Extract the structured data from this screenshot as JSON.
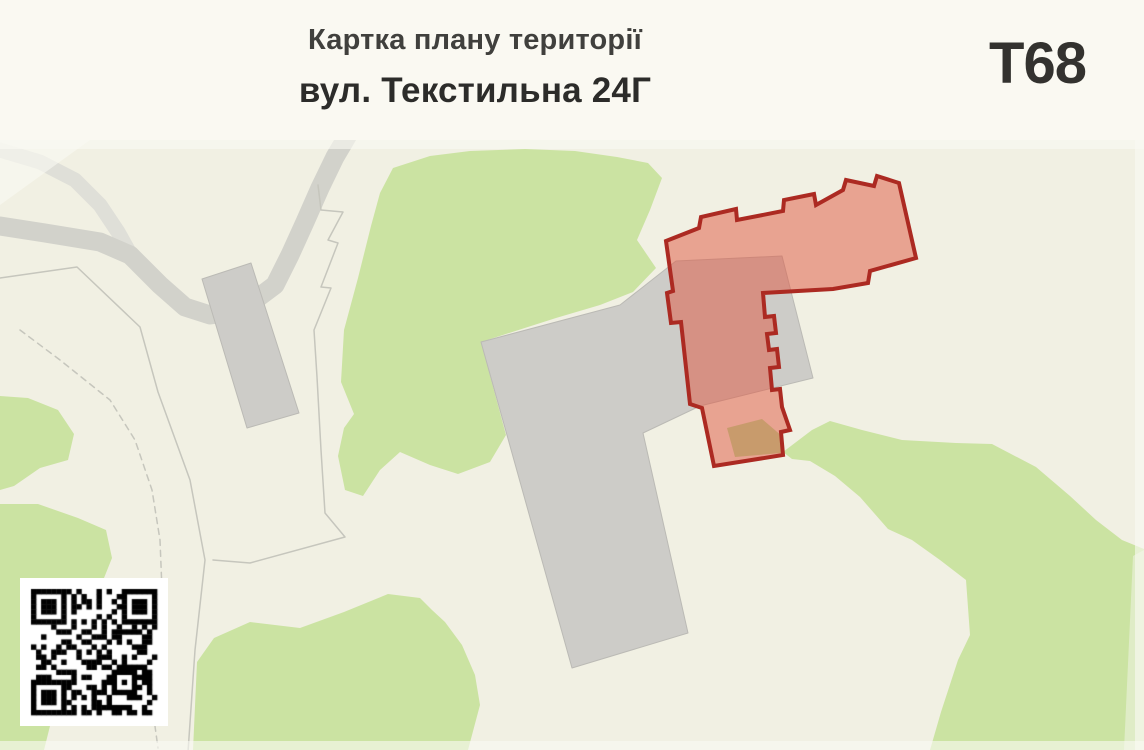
{
  "header": {
    "title": "Картка плану території",
    "subtitle": "вул. Текстильна 24Г",
    "badge": "Т68"
  },
  "map": {
    "colors": {
      "background": "#f1f0e3",
      "green": "#cbe3a2",
      "green_light": "#dfecc6",
      "road": "#d2d2cb",
      "road_light": "#dfdfd8",
      "parcel": "#c6c6bd",
      "building": "#cdccc8",
      "building_edge": "#bbbab5",
      "highlight_fill": "rgba(223,86,64,0.5)",
      "highlight_stroke": "#ac2a22",
      "tan": "#bf9963",
      "fade": "rgba(250,250,243,0.6)"
    },
    "features": [
      {
        "name": "greenery-central",
        "type": "polygon",
        "fill": "green",
        "points": "393,168 430,156 470,151 525,149 575,151 617,157 648,163 662,178 650,210 637,240 656,268 633,292 600,305 556,318 481,342 506,435 490,462 458,474 430,465 400,452 380,470 363,496 345,490 338,456 344,428 354,414 341,382 344,330 358,278 371,226 380,193"
      },
      {
        "name": "greenery-bottom-center",
        "type": "polygon",
        "fill": "green",
        "points": "193,750 197,662 214,638 250,622 300,628 344,612 388,594 420,598 432,610 445,622 462,645 475,675 480,705 468,750"
      },
      {
        "name": "greenery-left-upper",
        "type": "polygon",
        "fill": "green",
        "points": "0,396 28,398 58,410 74,434 68,460 40,468 14,486 0,490"
      },
      {
        "name": "greenery-left-lower",
        "type": "polygon",
        "fill": "green",
        "points": "0,504 38,504 78,518 106,530 112,558 100,588 102,616 88,638 60,648 48,678 52,718 44,750 0,750"
      },
      {
        "name": "greenery-bottom-right",
        "type": "polygon",
        "fill": "green",
        "points": "783,452 812,430 830,421 862,430 902,440 956,443 992,444 1036,467 1070,496 1096,520 1122,540 1144,549 1144,750 930,750 941,712 958,660 970,635 966,580 940,560 912,540 888,529 860,497 835,476 810,461 792,459"
      },
      {
        "name": "greenery-right-edge",
        "type": "polygon",
        "fill": "green_light",
        "points": "1133,556 1144,550 1144,750 1124,750"
      },
      {
        "name": "road-secondary",
        "type": "polyline",
        "stroke": "road_light",
        "width": 15,
        "points": "0,150 40,162 75,180 100,205 118,232 128,250"
      },
      {
        "name": "road-main",
        "type": "polyline",
        "stroke": "road",
        "width": 19,
        "points": "0,226 45,233 100,242 130,255 160,285 185,307 210,315 235,312 255,300 275,285 290,255 305,222 320,188 335,157 348,135"
      },
      {
        "name": "parcel-line-west",
        "type": "polyline",
        "stroke": "parcel",
        "width": 1.5,
        "points": "0,278 77,267 140,327 158,392 190,480 205,560 195,650 188,752"
      },
      {
        "name": "parcel-line-east",
        "type": "polyline",
        "stroke": "parcel",
        "width": 1.5,
        "points": "318,185 321,210 343,212 328,240 338,243 321,287 331,288 314,330 317,377 321,450 325,513 345,537 250,563 213,560"
      },
      {
        "name": "parcel-line-dashed",
        "type": "polyline",
        "stroke": "parcel",
        "width": 1.5,
        "dash": "6 5",
        "points": "20,330 60,360 110,400 135,440 152,490 160,540 162,590 156,640 150,690 158,748"
      },
      {
        "name": "building-small",
        "type": "polygon",
        "fill": "building",
        "stroke": "building_edge",
        "width": 1,
        "points": "202,279 251,263 299,413 247,428"
      },
      {
        "name": "building-complex",
        "type": "polygon",
        "fill": "building",
        "stroke": "building_edge",
        "width": 1,
        "points": "481,342 620,305 676,261 782,256 813,378 700,406 643,433 688,633 572,668"
      },
      {
        "name": "highlight-parcel-fill",
        "type": "polygon",
        "fill": "highlight_fill",
        "points": "666,241 699,228 701,217 736,209 737,220 783,211 784,200 814,194 816,205 843,190 846,180 874,186 877,176 899,183 916,258 870,271 868,283 833,289 763,293 765,317 774,316 776,333 767,334 769,350 777,349 779,367 770,368 772,390 780,389 782,407 790,430 781,432 783,455 714,466 702,408 690,404 681,322 671,323 667,293 673,291"
      },
      {
        "name": "ground-patch-tan",
        "type": "polygon",
        "fill": "tan",
        "opacity": 0.8,
        "points": "727,428 762,419 783,437 781,453 735,457"
      },
      {
        "name": "highlight-parcel-outline",
        "type": "polygon",
        "fill": "none",
        "stroke": "highlight_stroke",
        "width": 4,
        "points": "666,241 699,228 701,217 736,209 737,220 783,211 784,200 814,194 816,205 843,190 846,180 874,186 877,176 899,183 916,258 870,271 868,283 833,289 763,293 765,317 774,316 776,333 767,334 769,350 777,349 779,367 770,368 772,390 780,389 782,407 790,430 781,432 783,455 714,466 702,408 690,404 681,322 671,323 667,293 673,291"
      },
      {
        "name": "map-fade-top",
        "type": "polygon",
        "fill": "fade",
        "points": "0,140 1144,140 1144,149 0,149"
      },
      {
        "name": "map-fade-right",
        "type": "polygon",
        "fill": "fade",
        "points": "1135,140 1144,140 1144,750 1135,750"
      },
      {
        "name": "map-fade-bottom",
        "type": "polygon",
        "fill": "fade",
        "points": "0,741 1144,741 1144,750 0,750"
      },
      {
        "name": "map-streak-topleft",
        "type": "polygon",
        "fill": "fade",
        "points": "0,140 90,140 0,205"
      }
    ]
  },
  "qr": {
    "label": "qr-code",
    "modules": 25,
    "margin": 11,
    "size": 148,
    "seed": 9
  }
}
